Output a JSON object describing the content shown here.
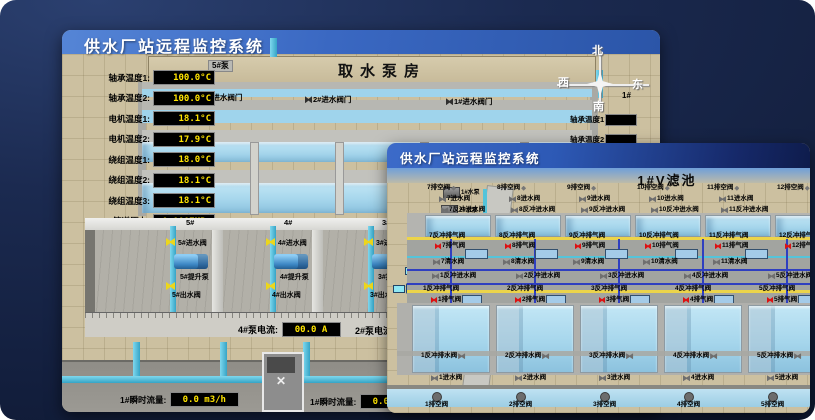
{
  "back_window": {
    "title": "供水厂站远程监控系统",
    "scene_title": "取水泵房",
    "pump_panel": {
      "header": "5#泵",
      "rows": [
        {
          "label": "轴承温度1:",
          "value": "100.0°C"
        },
        {
          "label": "轴承温度2:",
          "value": "100.0°C"
        },
        {
          "label": "电机温度1:",
          "value": "18.1°C"
        },
        {
          "label": "电机温度2:",
          "value": "17.9°C"
        },
        {
          "label": "绕组温度1:",
          "value": "18.0°C"
        },
        {
          "label": "绕组温度2:",
          "value": "18.1°C"
        },
        {
          "label": "绕组温度3:",
          "value": "18.1°C"
        },
        {
          "label": "管道压力:",
          "value": "0.0007MPa"
        },
        {
          "label": "多功能阀:",
          "value": "0%"
        }
      ]
    },
    "intake_valves": [
      {
        "t": "3#进水阀门",
        "x": 134,
        "y": 64
      },
      {
        "t": "2#进水阀门",
        "x": 243,
        "y": 66
      },
      {
        "t": "1#进水阀门",
        "x": 384,
        "y": 68
      }
    ],
    "compass": {
      "north": "北",
      "south": "南",
      "east": "东",
      "west": "西"
    },
    "side_header": "1#",
    "side_labels": [
      {
        "t": "轴承温度1",
        "x": 508,
        "y": 84
      },
      {
        "t": "轴承温度2",
        "x": 508,
        "y": 104
      }
    ],
    "bay_numbers": [
      {
        "t": "5#",
        "x": 124
      },
      {
        "t": "4#",
        "x": 222
      },
      {
        "t": "3#",
        "x": 320
      },
      {
        "t": "2#",
        "x": 420
      }
    ],
    "pump_bays": [
      {
        "inlet": "5#进水阀",
        "pump": "5#提升泵",
        "outlet": "5#出水阀",
        "x": 58
      },
      {
        "inlet": "4#进水阀",
        "pump": "4#提升泵",
        "outlet": "4#出水阀",
        "x": 158
      },
      {
        "inlet": "3#进水阀",
        "pump": "3#提升泵",
        "outlet": "3#出水阀",
        "x": 256
      },
      {
        "inlet": "2#进水阀",
        "pump": "2#提升泵",
        "outlet": "2#出水阀",
        "x": 356
      }
    ],
    "current_left": {
      "label": "4#泵电流:",
      "value": "00.0 A"
    },
    "current_right": {
      "label": "2#泵电流"
    },
    "flow_left": {
      "label": "1#瞬时流量:",
      "value": "0.0 m3/h"
    },
    "flow_right": {
      "label": "1#瞬时流量:",
      "value": "0.0 m3/h"
    }
  },
  "front_window": {
    "title": "供水厂站远程监控系统",
    "scene_title": "1#V滤池",
    "pumps": [
      {
        "t": "1#水泵",
        "x": 56,
        "y": 44
      },
      {
        "t": "2#水泵",
        "x": 54,
        "y": 62
      },
      {
        "t": "3#水泵",
        "x": 42,
        "y": 80
      }
    ],
    "blowers": [
      {
        "t": "1#风机",
        "x": 20,
        "y": 102
      },
      {
        "t": "2#风机",
        "x": 18,
        "y": 122
      },
      {
        "t": "3#风机",
        "x": 6,
        "y": 140
      }
    ],
    "drain_top": [
      {
        "t": "7排空阀",
        "x": 40
      },
      {
        "t": "8排空阀",
        "x": 110
      },
      {
        "t": "9排空阀",
        "x": 180
      },
      {
        "t": "10排空阀",
        "x": 250
      },
      {
        "t": "11排空阀",
        "x": 320
      },
      {
        "t": "12排空阀",
        "x": 390
      }
    ],
    "inlet_top": [
      {
        "t": "7进水阀",
        "x": 52
      },
      {
        "t": "8进水阀",
        "x": 122
      },
      {
        "t": "9进水阀",
        "x": 192
      },
      {
        "t": "10进水阀",
        "x": 262
      },
      {
        "t": "11进水阀",
        "x": 332
      }
    ],
    "bw_inlet_top": [
      {
        "t": "7反冲进水阀",
        "x": 54
      },
      {
        "t": "8反冲进水阀",
        "x": 124
      },
      {
        "t": "9反冲进水阀",
        "x": 194
      },
      {
        "t": "10反冲进水阀",
        "x": 264
      },
      {
        "t": "11反冲进水阀",
        "x": 334
      }
    ],
    "upper_pools": [
      {
        "x": 38
      },
      {
        "x": 108
      },
      {
        "x": 178
      },
      {
        "x": 248
      },
      {
        "x": 318
      },
      {
        "x": 388
      }
    ],
    "bw_exhaust_top": [
      {
        "t": "7反冲排气阀",
        "x": 42
      },
      {
        "t": "8反冲排气阀",
        "x": 112
      },
      {
        "t": "9反冲排气阀",
        "x": 182
      },
      {
        "t": "10反冲排气阀",
        "x": 252
      },
      {
        "t": "11反冲排气阀",
        "x": 322
      },
      {
        "t": "12反冲排气阀",
        "x": 392
      }
    ],
    "air_top": [
      {
        "t": "7排气阀",
        "x": 48
      },
      {
        "t": "8排气阀",
        "x": 118
      },
      {
        "t": "9排气阀",
        "x": 188
      },
      {
        "t": "10排气阀",
        "x": 258
      },
      {
        "t": "11排气阀",
        "x": 328
      },
      {
        "t": "12排气阀",
        "x": 398
      }
    ],
    "level_boxes_top": [
      {
        "x": 78
      },
      {
        "x": 148
      },
      {
        "x": 218
      },
      {
        "x": 288
      },
      {
        "x": 358
      }
    ],
    "clean_mid": [
      {
        "t": "7清水阀",
        "x": 46
      },
      {
        "t": "8清水阀",
        "x": 116
      },
      {
        "t": "9清水阀",
        "x": 186
      },
      {
        "t": "10清水阀",
        "x": 256
      },
      {
        "t": "11清水阀",
        "x": 326
      }
    ],
    "bw_inlet_low": [
      {
        "t": "1反冲进水阀",
        "x": 45
      },
      {
        "t": "2反冲进水阀",
        "x": 129
      },
      {
        "t": "3反冲进水阀",
        "x": 213
      },
      {
        "t": "4反冲进水阀",
        "x": 297
      },
      {
        "t": "5反冲进水阀",
        "x": 381
      }
    ],
    "bw_exhaust_low": [
      {
        "t": "1反冲排气阀",
        "x": 36
      },
      {
        "t": "2反冲排气阀",
        "x": 120
      },
      {
        "t": "3反冲排气阀",
        "x": 204
      },
      {
        "t": "4反冲排气阀",
        "x": 288
      },
      {
        "t": "5反冲排气阀",
        "x": 372
      }
    ],
    "air_low": [
      {
        "t": "1排气阀",
        "x": 44
      },
      {
        "t": "2排气阀",
        "x": 128
      },
      {
        "t": "3排气阀",
        "x": 212
      },
      {
        "t": "4排气阀",
        "x": 296
      },
      {
        "t": "5排气阀",
        "x": 380
      }
    ],
    "lower_pools": [
      {
        "x": 25
      },
      {
        "x": 109
      },
      {
        "x": 193
      },
      {
        "x": 277
      },
      {
        "x": 361
      }
    ],
    "bw_drain_low": [
      {
        "t": "1反冲排水阀",
        "x": 34
      },
      {
        "t": "2反冲排水阀",
        "x": 118
      },
      {
        "t": "3反冲排水阀",
        "x": 202
      },
      {
        "t": "4反冲排水阀",
        "x": 286
      },
      {
        "t": "5反冲排水阀",
        "x": 370
      }
    ],
    "inlet_low": [
      {
        "t": "1进水阀",
        "x": 44
      },
      {
        "t": "2进水阀",
        "x": 128
      },
      {
        "t": "3进水阀",
        "x": 212
      },
      {
        "t": "4进水阀",
        "x": 296
      },
      {
        "t": "5进水阀",
        "x": 380
      }
    ],
    "drain_low": [
      {
        "t": "1排空阀",
        "x": 38
      },
      {
        "t": "2排空阀",
        "x": 122
      },
      {
        "t": "3排空阀",
        "x": 206
      },
      {
        "t": "4排空阀",
        "x": 290
      },
      {
        "t": "5排空阀",
        "x": 374
      }
    ]
  },
  "colors": {
    "accent_blue": "#2d59b5",
    "value_yellow": "#ffe400",
    "alarm_red": "#dd1111",
    "pipe_cyan": "#4db8d4"
  }
}
